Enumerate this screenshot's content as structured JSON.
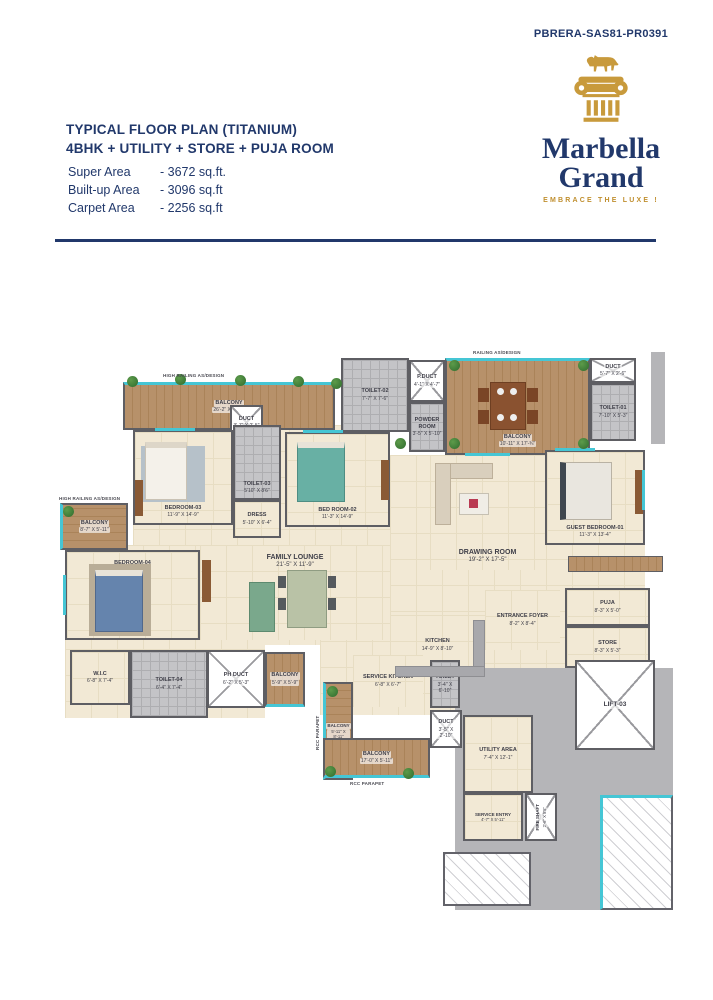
{
  "page": {
    "rera": "PBRERA-SAS81-PR0391"
  },
  "logo": {
    "brand_line1": "Marbella",
    "brand_line2": "Grand",
    "tagline": "EMBRACE THE LUXE !"
  },
  "header": {
    "title_line1": "TYPICAL FLOOR PLAN (TITANIUM)",
    "title_line2": "4BHK + UTILITY + STORE + PUJA ROOM",
    "areas": [
      {
        "label": "Super Area",
        "value": "-  3672 sq.ft."
      },
      {
        "label": "Built-up Area",
        "value": "-  3096 sq.ft"
      },
      {
        "label": "Carpet Area",
        "value": "-  2256 sq.ft"
      }
    ]
  },
  "plan": {
    "annotations": {
      "high_railing": "HIGH RAILING AS/DESIGN",
      "railing": "RAILING AS/DESIGN",
      "rcc_parapet": "RCC PARAPET"
    },
    "colors": {
      "navy": "#21386b",
      "gold": "#c89a3c",
      "floor_cream": "#f2e9d5",
      "balcony_wood": "#b7916a",
      "wall_gray": "#5e5e63",
      "window_teal": "#45c6d5",
      "corridor_gray": "#b5b5b8"
    },
    "rooms": [
      {
        "name": "BALCONY",
        "dims": "26'-2\" X 5'-11\""
      },
      {
        "name": "DUCT",
        "dims": "3'-7\" X 2'-5\""
      },
      {
        "name": "TOILET-02",
        "dims": "7'-7\" X 7'-6\""
      },
      {
        "name": "P.DUCT",
        "dims": "4'-1\" X 4'-7\""
      },
      {
        "name": "POWDER ROOM",
        "dims": "3'-5\" X 5'-10\""
      },
      {
        "name": "BALCONY",
        "dims": "10'-11\" X 17'-¾\""
      },
      {
        "name": "DUCT",
        "dims": "5'-7\" X 2'-6\""
      },
      {
        "name": "TOILET-01",
        "dims": "7'-10\" X 5'-3\""
      },
      {
        "name": "BEDROOM-03",
        "dims": "11'-9\" X 14'-9\""
      },
      {
        "name": "TOILET-03",
        "dims": "5'10\" X 8'6\""
      },
      {
        "name": "DRESS",
        "dims": "5'-10\" X 6'-4\""
      },
      {
        "name": "BED ROOM-02",
        "dims": "11'-3\" X 14'-9\""
      },
      {
        "name": "BALCONY",
        "dims": "8'-7\" X 5'-11\""
      },
      {
        "name": "BEDROOM-04",
        "dims": "16'-8\" X 11'-9\""
      },
      {
        "name": "FAMILY LOUNGE",
        "dims": "21'-5\" X 11'-9\""
      },
      {
        "name": "DRAWING ROOM",
        "dims": "19'-2\" X 17'-5\""
      },
      {
        "name": "GUEST BEDROOM-01",
        "dims": "11'-3\" X 13'-4\""
      },
      {
        "name": "ENTRANCE FOYER",
        "dims": "8'-2\" X 8'-4\""
      },
      {
        "name": "PUJA",
        "dims": "8'-3\" X 5'-0\""
      },
      {
        "name": "STORE",
        "dims": "8'-3\" X 5'-3\""
      },
      {
        "name": "KITCHEN",
        "dims": "14'-9\" X 8'-10\""
      },
      {
        "name": "SERVICE KITCHEN",
        "dims": "6'-8\" X 6'-7\""
      },
      {
        "name": "TOILET",
        "dims": "3'-4\" X 6'-10\""
      },
      {
        "name": "DUCT",
        "dims": "3'-5\" X 2'-10\""
      },
      {
        "name": "W.I.C",
        "dims": "6'-8\" X 7'-4\""
      },
      {
        "name": "TOILET-04",
        "dims": "6'-4\" X 7'-4\""
      },
      {
        "name": "PH DUCT",
        "dims": "6'-2\" X 5'-3\""
      },
      {
        "name": "BALCONY",
        "dims": "5'-9\" X 5'-9\""
      },
      {
        "name": "BALCONY",
        "dims": "5'-11\" X 8'-11\""
      },
      {
        "name": "BALCONY",
        "dims": "17'-0\" X 5'-11\""
      },
      {
        "name": "UTILITY AREA",
        "dims": "7'-4\" X 12'-1\""
      },
      {
        "name": "SERVICE ENTRY",
        "dims": "4'-7\" X 5'-11\""
      },
      {
        "name": "FIRE SHAFT",
        "dims": "2'-6\" X 5'5\""
      },
      {
        "name": "LIFT-03",
        "dims": ""
      }
    ]
  }
}
